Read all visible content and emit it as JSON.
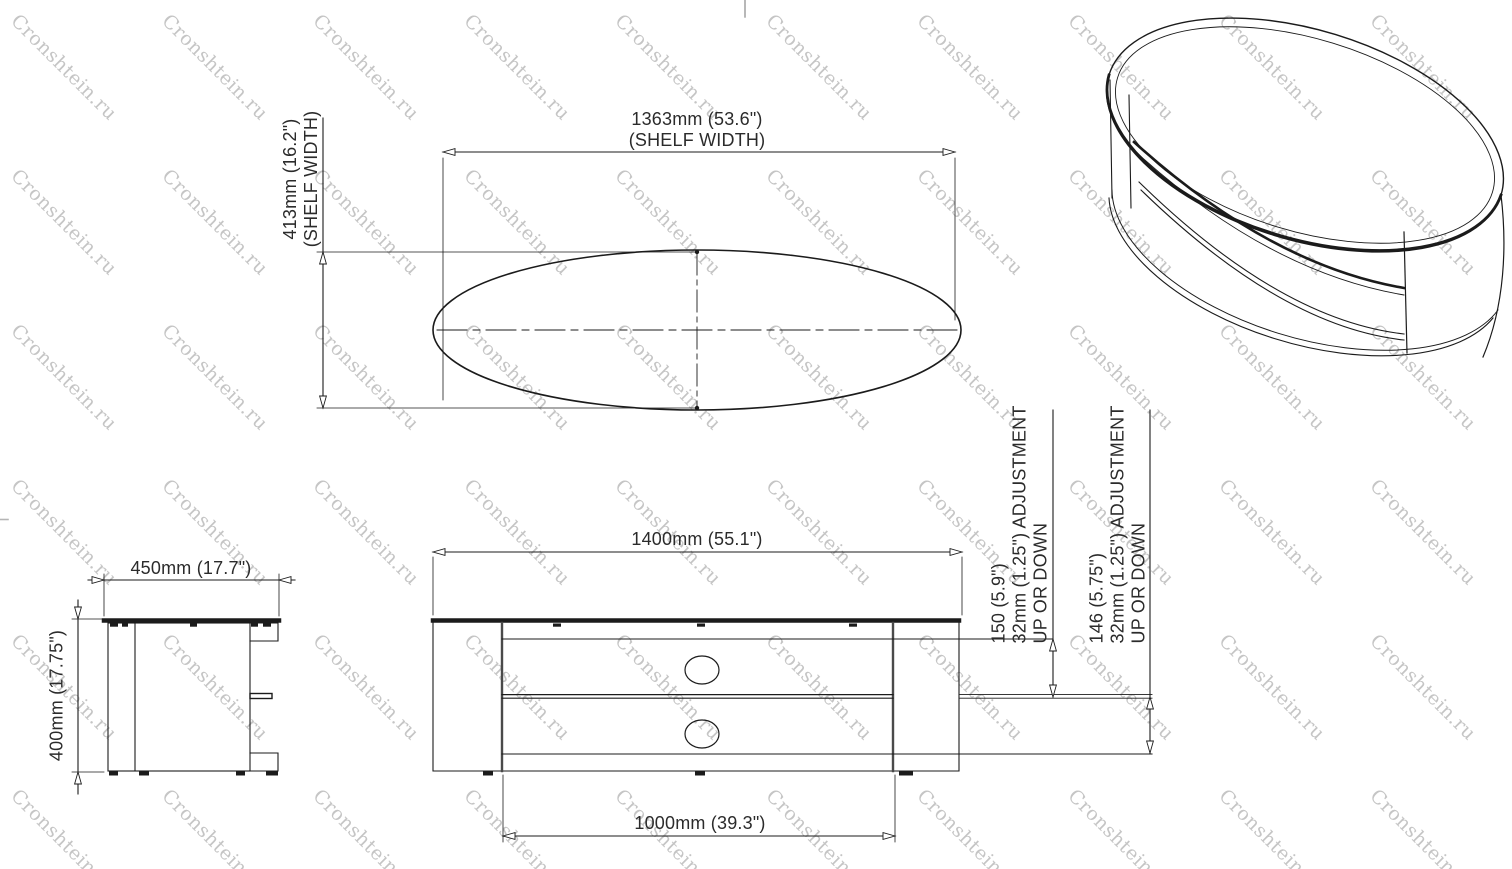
{
  "watermark": {
    "text": "Cronshtein.ru",
    "rows": 6,
    "cols": 10
  },
  "drawing": {
    "top_view": {
      "dim_shelf_width": {
        "value": "1363mm (53.6\")",
        "label": "(SHELF WIDTH)"
      },
      "dim_shelf_depth": {
        "value": "413mm (16.2\")",
        "label": "(SHELF WIDTH)"
      }
    },
    "side_view": {
      "dim_depth": "450mm (17.7\")",
      "dim_height": "400mm (17.75\")"
    },
    "front_view": {
      "dim_width": "1400mm (55.1\")",
      "dim_base_width": "1000mm (39.3\")",
      "dim_gap_top": {
        "value": "150 (5.9\")",
        "line2": "32mm (1.25\") ADJUSTMENT",
        "line3": "UP OR DOWN"
      },
      "dim_gap_bottom": {
        "value": "146 (5.75\")",
        "line2": "32mm (1.25\") ADJUSTMENT",
        "line3": "UP OR DOWN"
      }
    }
  },
  "colors": {
    "line": "#1b1b1b",
    "gray": "#8c8c8c",
    "text": "#2b2b2b",
    "watermark": "#c5c5c5"
  }
}
